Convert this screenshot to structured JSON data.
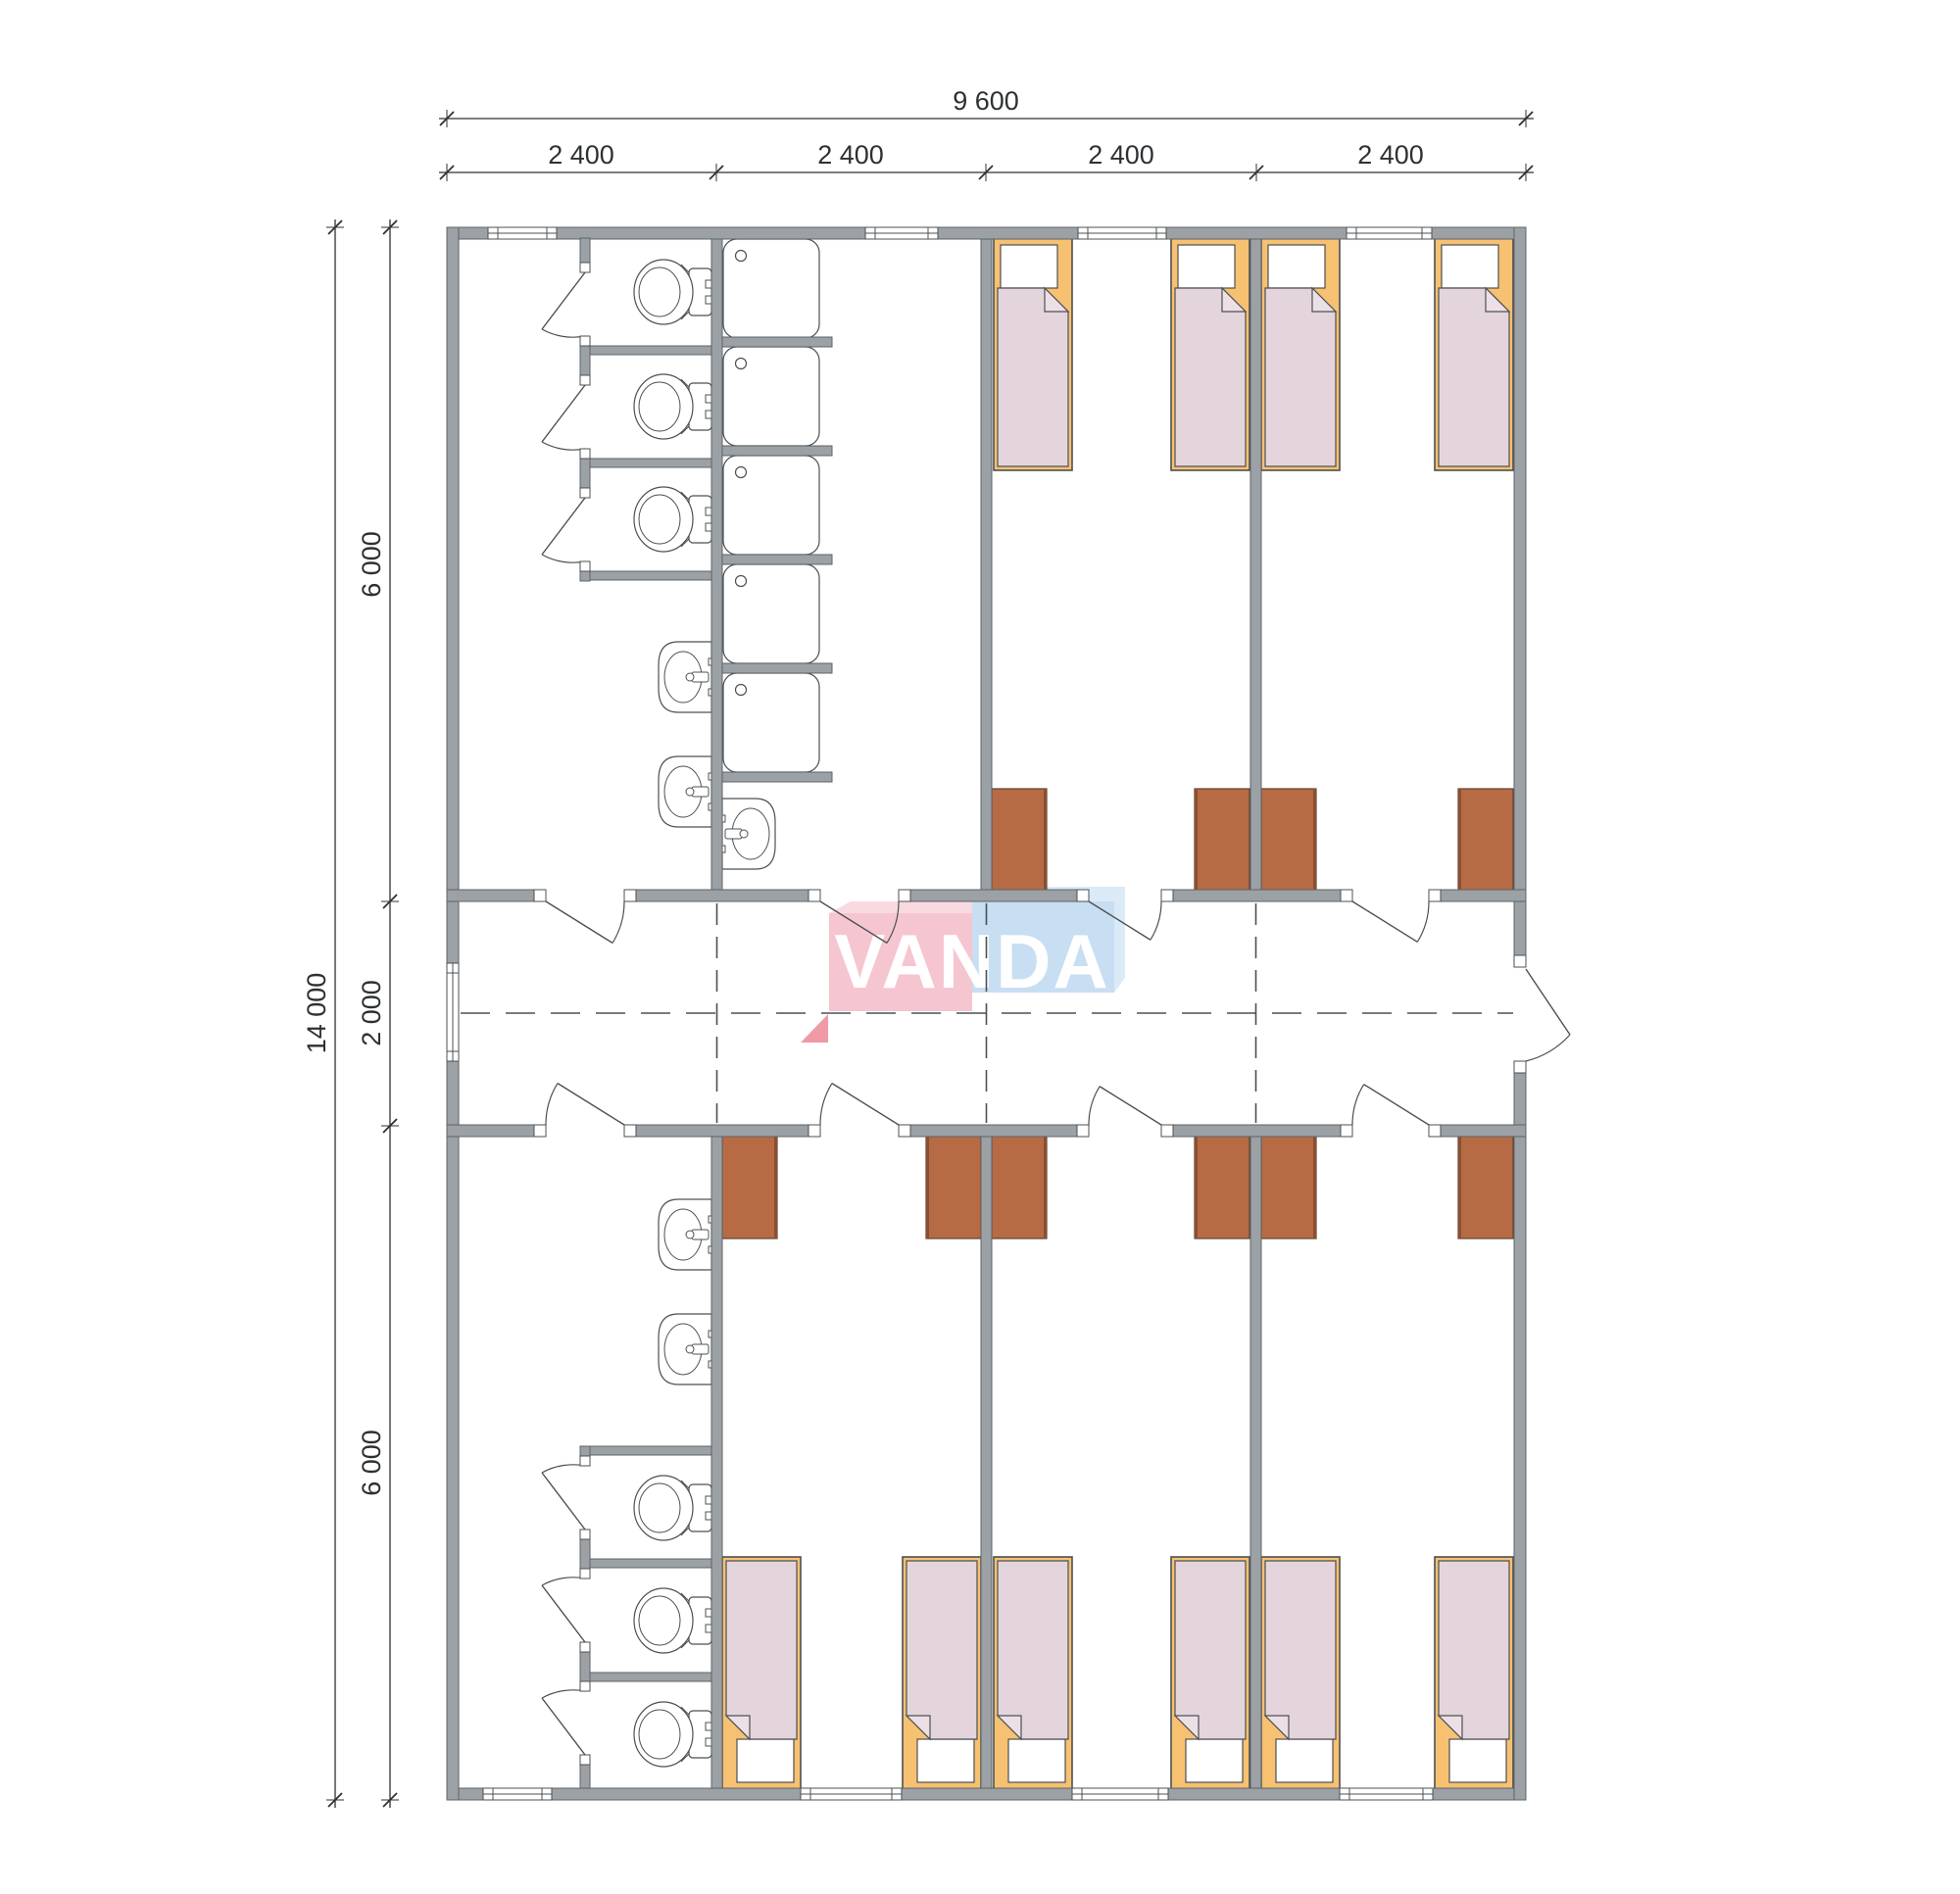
{
  "watermark": {
    "text": "VANDA",
    "text_color": "#ffffff",
    "pink_front": "#f5c6d0",
    "pink_back": "#f9dae0",
    "pink_side": "#ef9aa4",
    "blue_front": "#c8def2",
    "blue_back": "#daeaf7"
  },
  "dimensions": {
    "top": {
      "total": "9 600",
      "segments": [
        "2 400",
        "2 400",
        "2 400",
        "2 400"
      ]
    },
    "side": {
      "total": "14 000",
      "segments": [
        "6 000",
        "2 000",
        "6 000"
      ]
    }
  },
  "fixtures": {
    "beds": 10,
    "wardrobes": 10,
    "toilets": 6,
    "toilet_stalls": 6,
    "showers": 5,
    "washbasins": 5,
    "room_doors": 8,
    "stall_doors": 6,
    "exterior_doors": 1,
    "windows": 9
  },
  "colors": {
    "wall": "#9ba1a5",
    "wall_stroke": "#5f6467",
    "line": "#4c5053",
    "dash": "#4c5053",
    "dim": "#2e3133",
    "bed_frame": "#f7c172",
    "pillow": "#ffffff",
    "blanket": "#e4d5dc",
    "blanket_fold": "#ece0e6",
    "desk": "#b76b44",
    "desk_edge": "#8a4f31",
    "desk_stroke": "#5f4330",
    "fixture_fill": "#ffffff"
  }
}
